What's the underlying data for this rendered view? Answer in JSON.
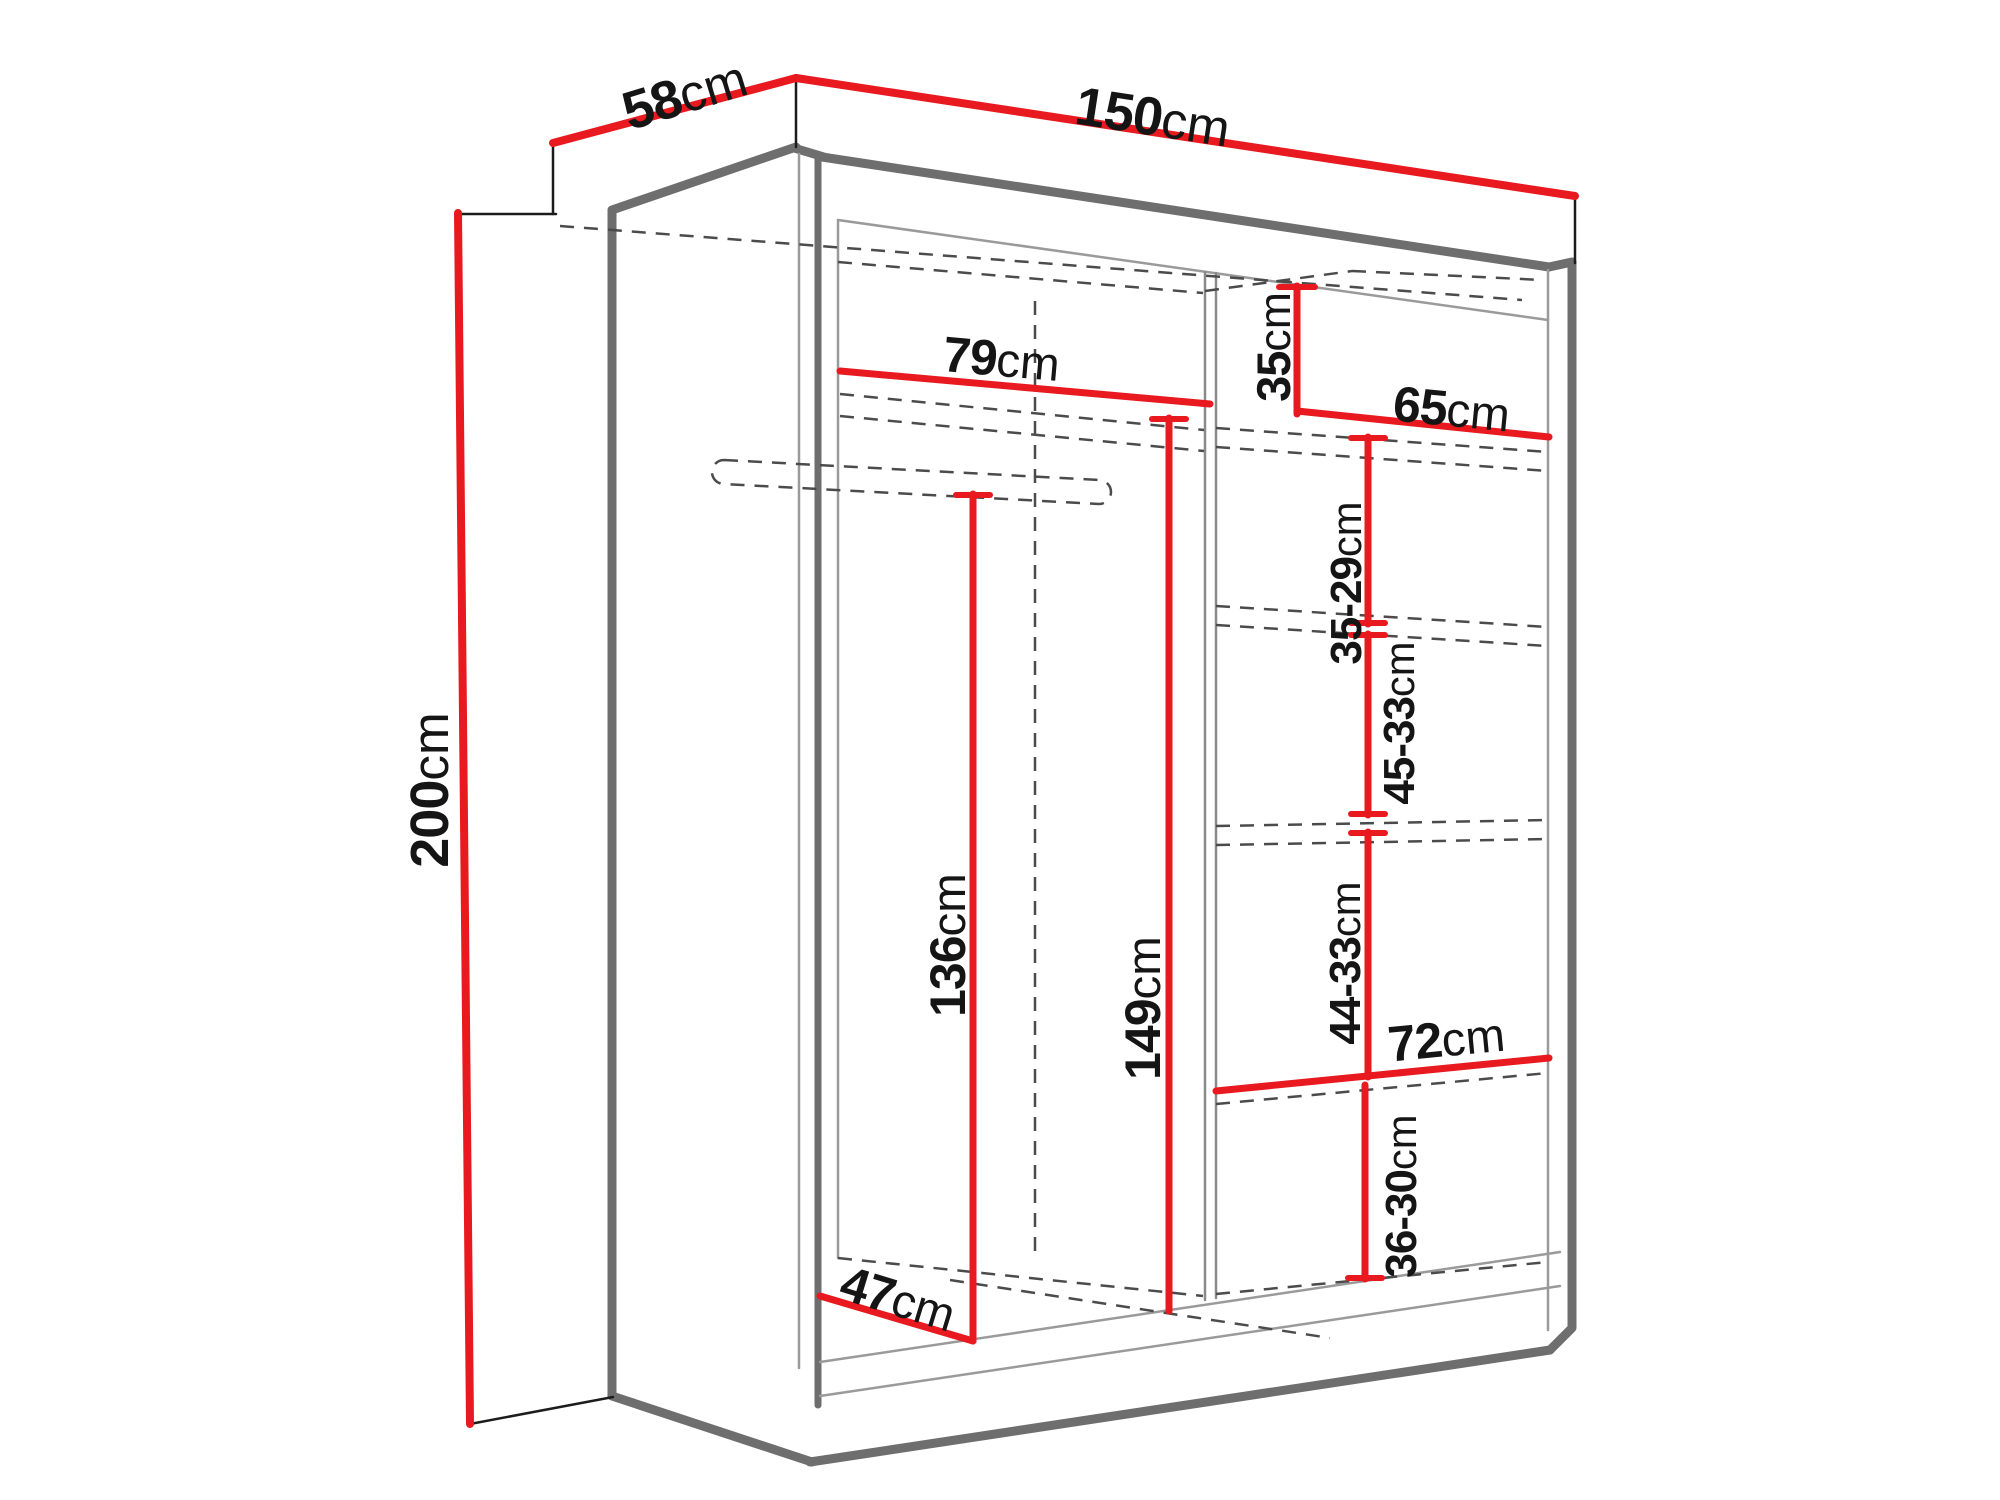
{
  "diagram": {
    "type": "wardrobe dimension diagram",
    "unit": "cm",
    "colors": {
      "dimension_red": "#e8191f",
      "outline_gray": "#6e6e6e",
      "thin_line_gray": "#9a9a9a",
      "dashed_gray": "#4b4b4b",
      "label_black": "#151515",
      "background": "#ffffff"
    },
    "overall": {
      "depth": {
        "num": "58",
        "unit": "cm"
      },
      "width": {
        "num": "150",
        "unit": "cm"
      },
      "height": {
        "num": "200",
        "unit": "cm"
      }
    },
    "interior": {
      "left_section_width": {
        "num": "79",
        "unit": "cm"
      },
      "top_right_shelf_height": {
        "num": "35",
        "unit": "cm"
      },
      "right_section_width": {
        "num": "65",
        "unit": "cm"
      },
      "right_shelf_gap_1": {
        "num": "35-29",
        "unit": "cm"
      },
      "right_shelf_gap_2": {
        "num": "45-33",
        "unit": "cm"
      },
      "right_shelf_gap_3": {
        "num": "44-33",
        "unit": "cm"
      },
      "hanging_space_height": {
        "num": "136",
        "unit": "cm"
      },
      "right_column_height": {
        "num": "149",
        "unit": "cm"
      },
      "bottom_shelf_width": {
        "num": "72",
        "unit": "cm"
      },
      "bottom_shelf_gap": {
        "num": "36-30",
        "unit": "cm"
      },
      "bottom_clear_depth": {
        "num": "47",
        "unit": "cm"
      }
    }
  }
}
